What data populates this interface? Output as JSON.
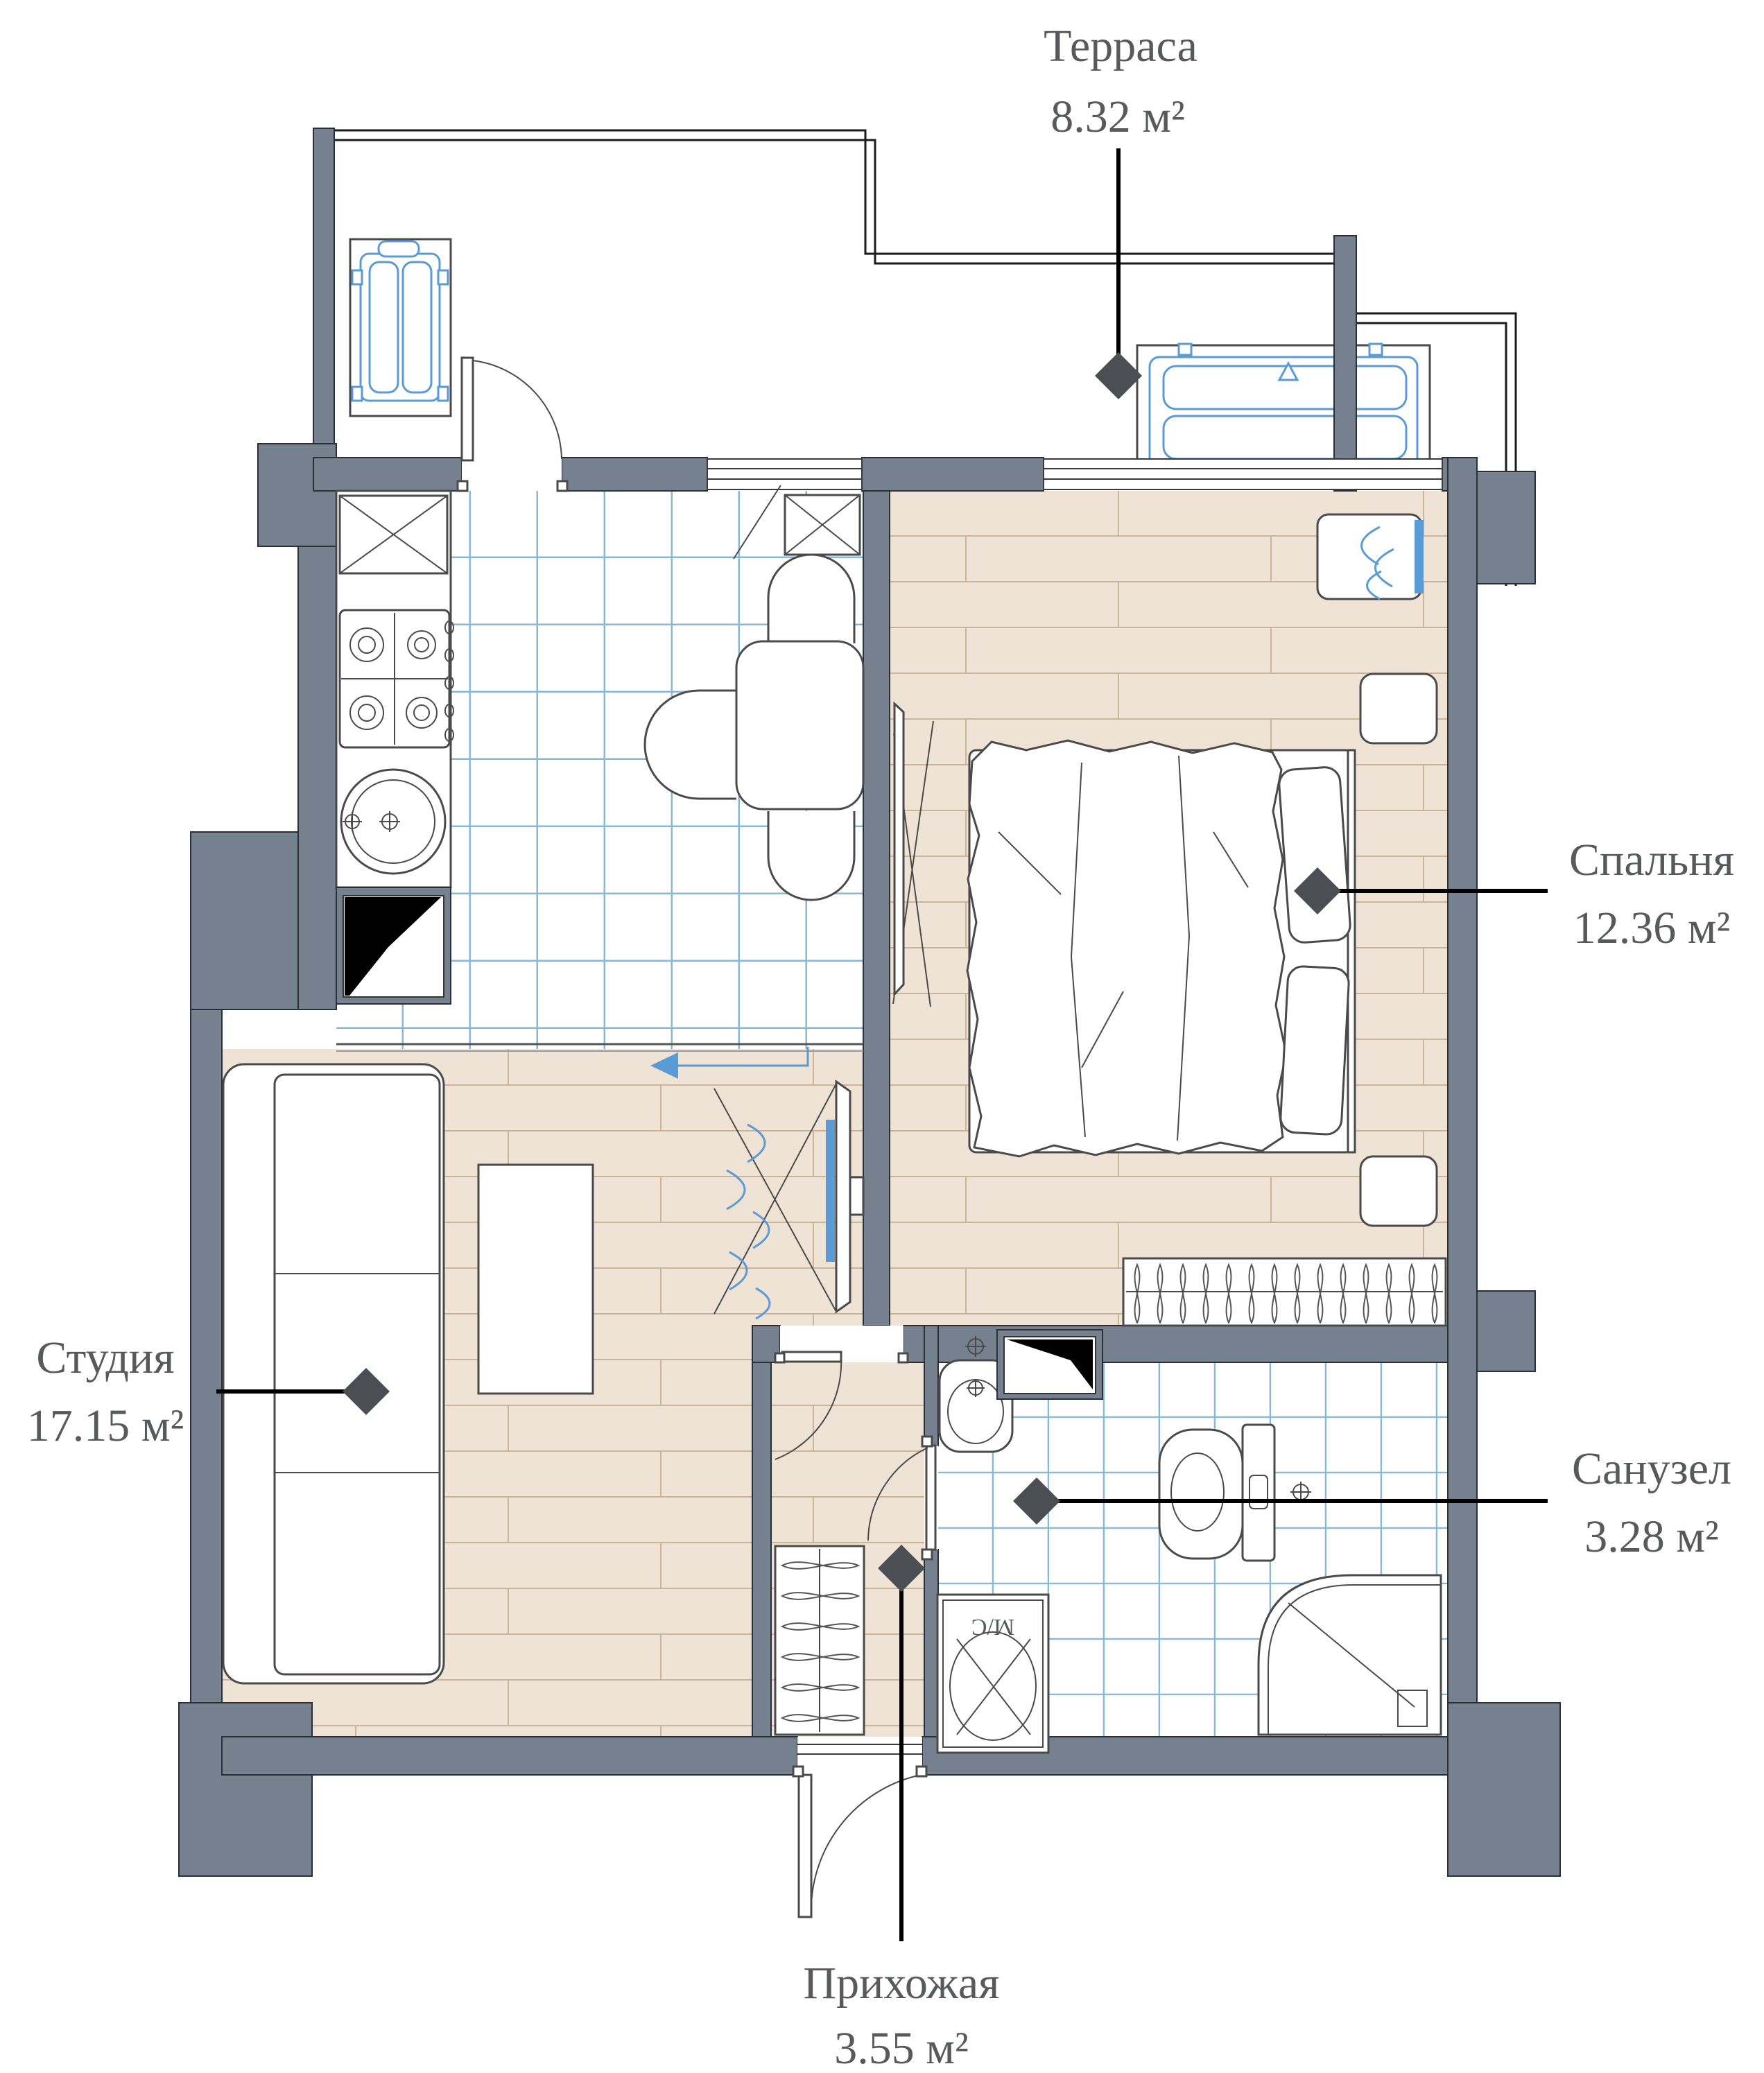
{
  "title": "Apartment floor plan",
  "colors": {
    "wall": "#75818e",
    "accent": "#5b9bd5",
    "tile": "#8ab7d8",
    "floor": "#eee3d5",
    "plank": "#ccb499",
    "furn": "#4a4a4a",
    "label": "#58595c"
  },
  "labels": {
    "terrace": {
      "name": "Терраса",
      "area": "8.32 м²"
    },
    "bedroom": {
      "name": "Спальня",
      "area": "12.36 м²"
    },
    "studio": {
      "name": "Студия",
      "area": "17.15 м²"
    },
    "bathroom": {
      "name": "Санузел",
      "area": "3.28 м²"
    },
    "hallway": {
      "name": "Прихожая",
      "area": "3.55 м²"
    }
  },
  "appliances": {
    "washer_label": "М/С"
  }
}
